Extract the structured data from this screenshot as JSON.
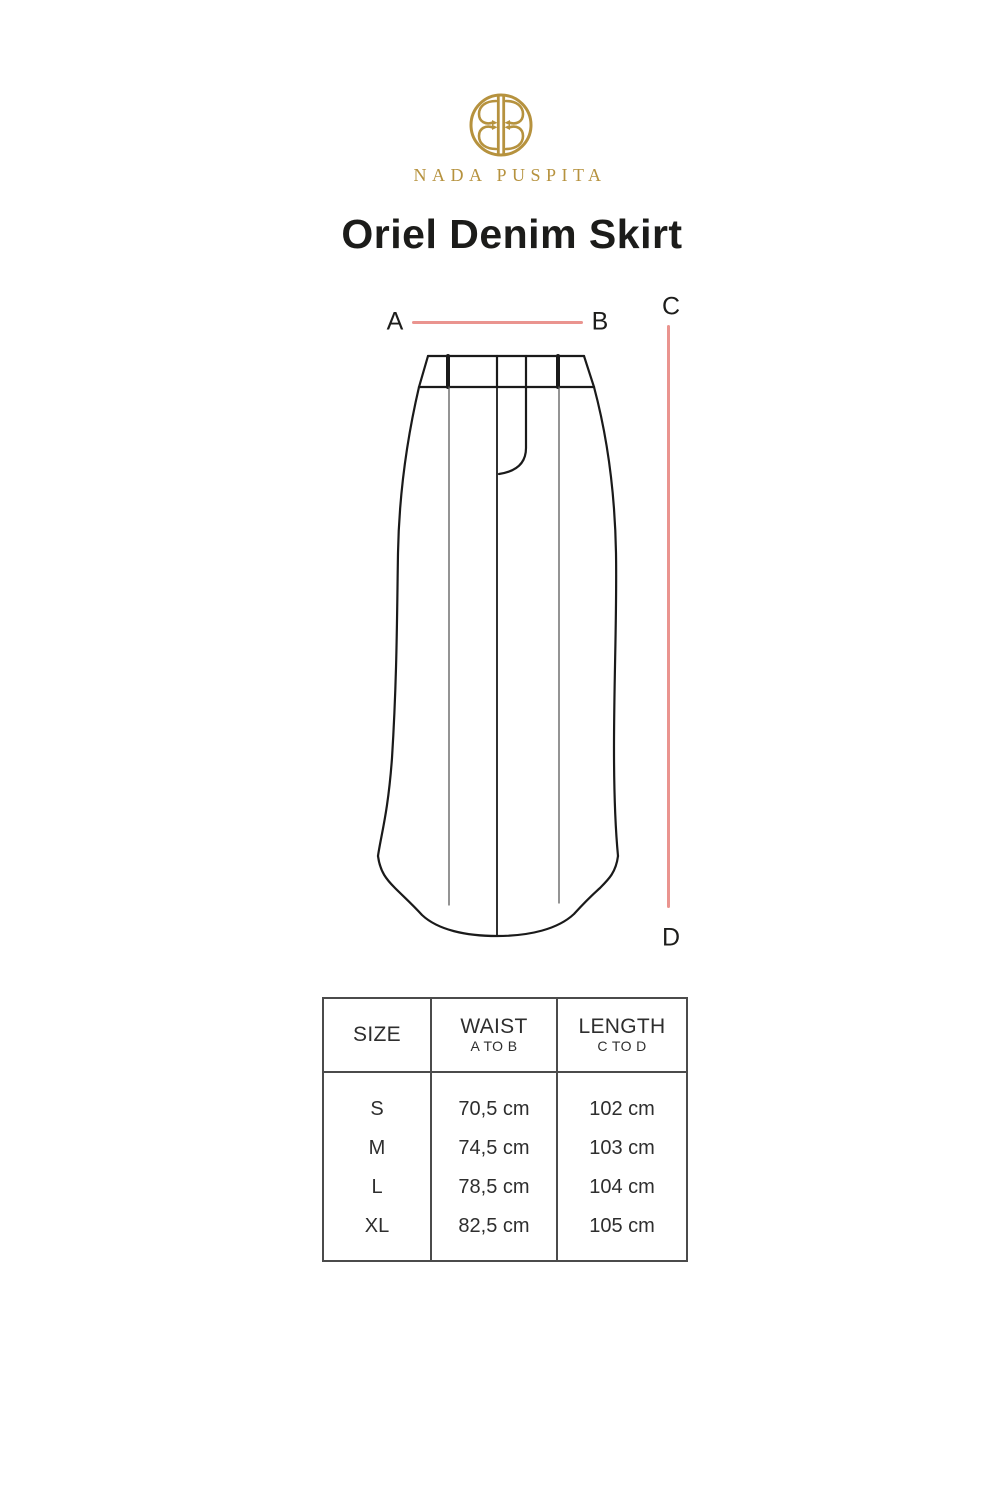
{
  "brand": {
    "name": "NADA PUSPITA"
  },
  "product": {
    "title": "Oriel Denim Skirt"
  },
  "diagram": {
    "label_a": "A",
    "label_b": "B",
    "label_c": "C",
    "label_d": "D"
  },
  "size_table": {
    "header": {
      "size": "SIZE",
      "waist": "WAIST",
      "waist_sub": "A TO B",
      "length": "LENGTH",
      "length_sub": "C TO D"
    },
    "rows": [
      {
        "size": "S",
        "waist": "70,5 cm",
        "length": "102 cm"
      },
      {
        "size": "M",
        "waist": "74,5 cm",
        "length": "103 cm"
      },
      {
        "size": "L",
        "waist": "78,5 cm",
        "length": "104 cm"
      },
      {
        "size": "XL",
        "waist": "82,5 cm",
        "length": "105 cm"
      }
    ]
  },
  "colors": {
    "gold": "#b6923e",
    "measure": "#ea948f",
    "table-border": "#4b4b4b"
  }
}
